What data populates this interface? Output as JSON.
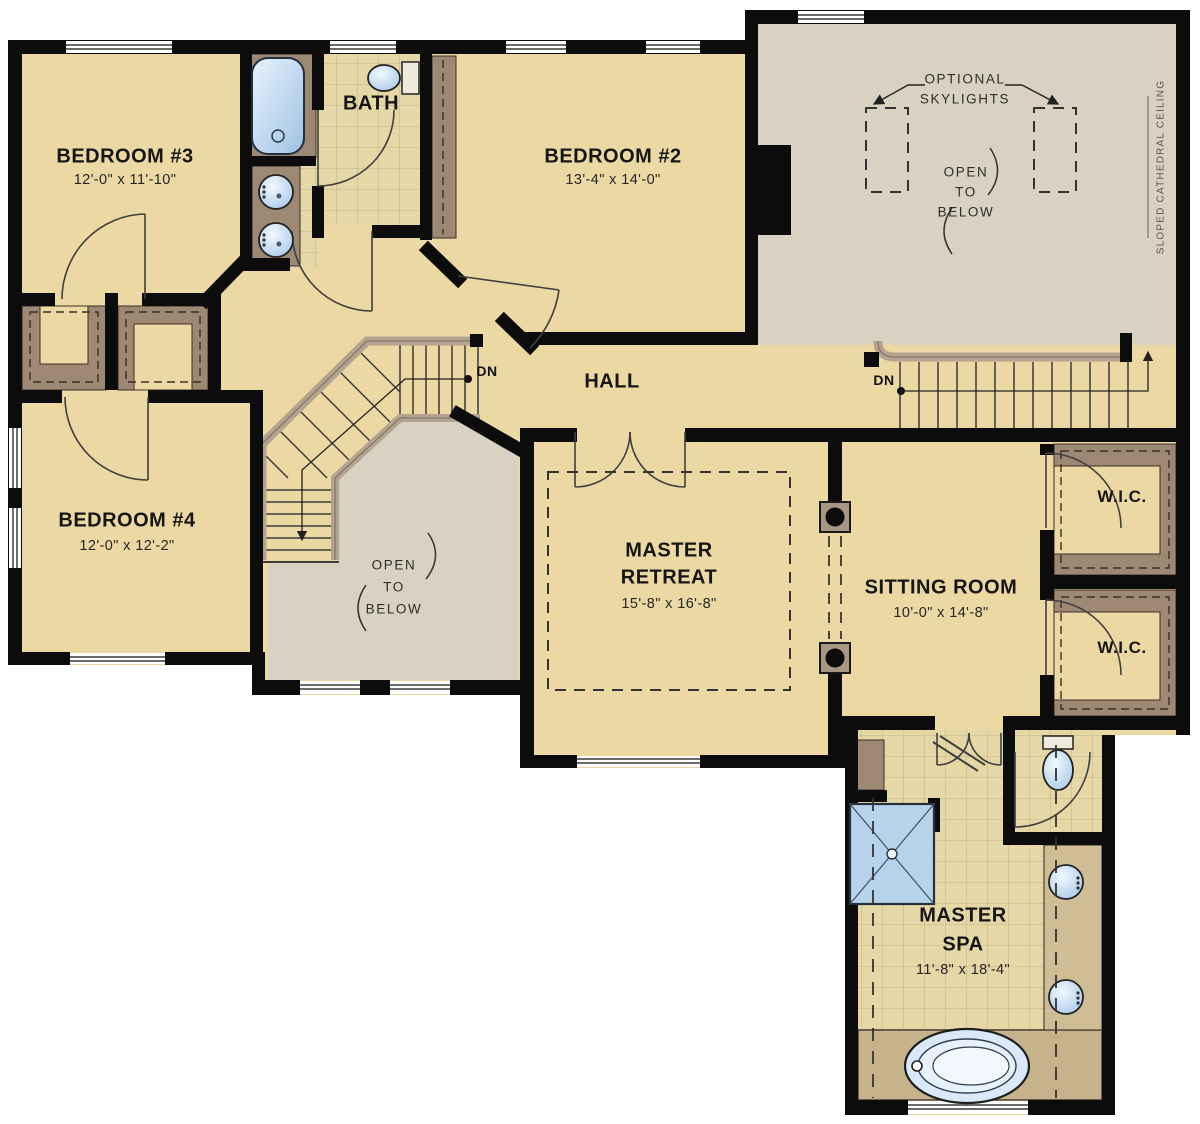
{
  "rooms": {
    "bedroom3": {
      "name": "BEDROOM #3",
      "dims": "12'-0\" x 11'-10\""
    },
    "bath": {
      "name": "BATH"
    },
    "bedroom2": {
      "name": "BEDROOM #2",
      "dims": "13'-4\" x 14'-0\""
    },
    "bedroom4": {
      "name": "BEDROOM #4",
      "dims": "12'-0\" x 12'-2\""
    },
    "hall": {
      "name": "HALL"
    },
    "master_retreat": {
      "line1": "MASTER",
      "line2": "RETREAT",
      "dims": "15'-8\" x 16'-8\""
    },
    "sitting_room": {
      "name": "SITTING ROOM",
      "dims": "10'-0\" x 14'-8\""
    },
    "wic_upper": {
      "name": "W.I.C."
    },
    "wic_lower": {
      "name": "W.I.C."
    },
    "master_spa": {
      "line1": "MASTER",
      "line2": "SPA",
      "dims": "11'-8\" x 18'-4\""
    }
  },
  "annotations": {
    "skylights_line1": "OPTIONAL",
    "skylights_line2": "SKYLIGHTS",
    "open_below": {
      "line1": "OPEN",
      "line2": "TO",
      "line3": "BELOW"
    },
    "sloped_ceiling": "SLOPED CATHEDRAL CEILING",
    "down": "DN"
  },
  "colors": {
    "floor_tan": "#ecd8a2",
    "open_below_gray": "#d9d2c3",
    "tile": "#e6d7a7",
    "wood_brown": "#9d8873",
    "wall_black": "#0c0c0c",
    "fixture_blue": "#bcd8f0",
    "platform_tan": "#c6b28b",
    "railing": "#b3a38f"
  }
}
